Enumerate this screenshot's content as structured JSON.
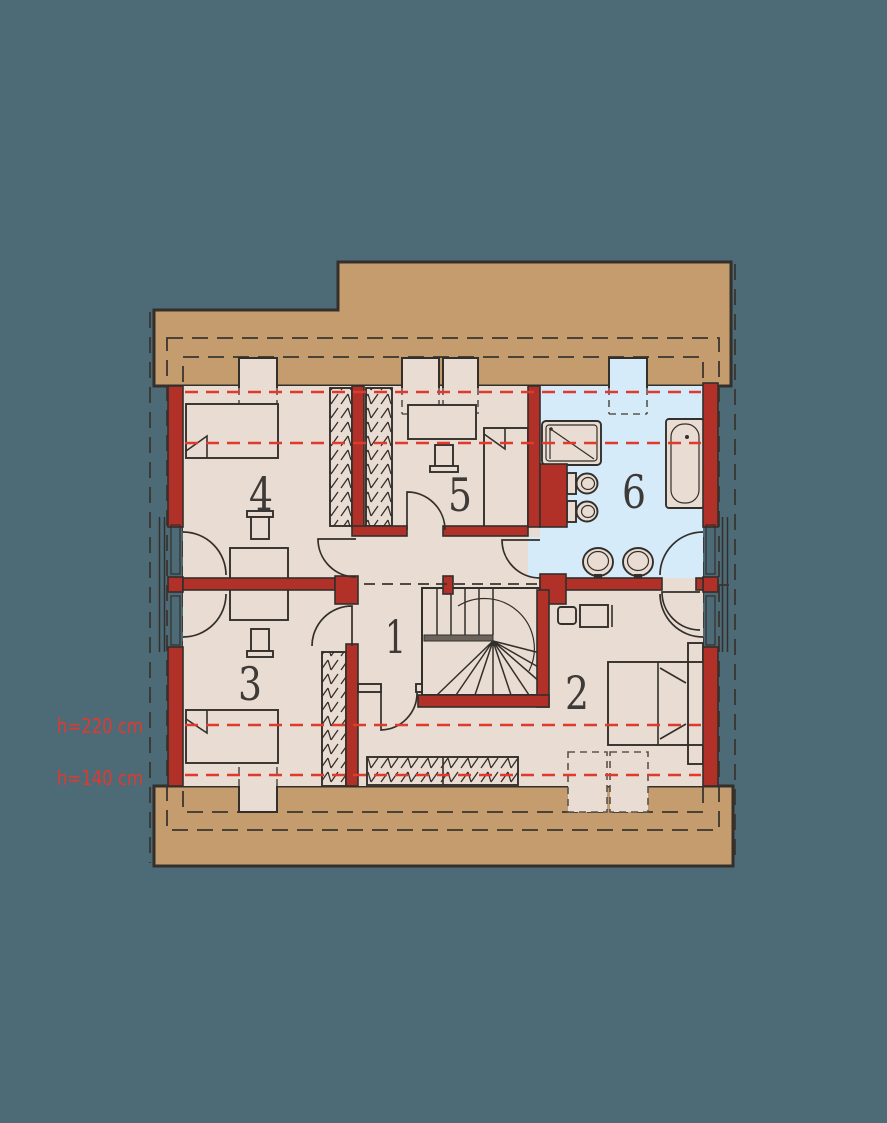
{
  "plan": {
    "colors": {
      "canvas": "#4d6a77",
      "roof": "#c59c6d",
      "floor": "#e9dcd2",
      "bath": "#d6ebfa",
      "wall": "#b13028",
      "outline": "#332f2b",
      "hline": "#e0392e",
      "label": "#3e3a37"
    },
    "rooms": [
      {
        "label": "1"
      },
      {
        "label": "2"
      },
      {
        "label": "3"
      },
      {
        "label": "4"
      },
      {
        "label": "5"
      },
      {
        "label": "6"
      }
    ],
    "annotations": {
      "h220": "h=220 cm",
      "h140": "h=140 cm"
    }
  }
}
